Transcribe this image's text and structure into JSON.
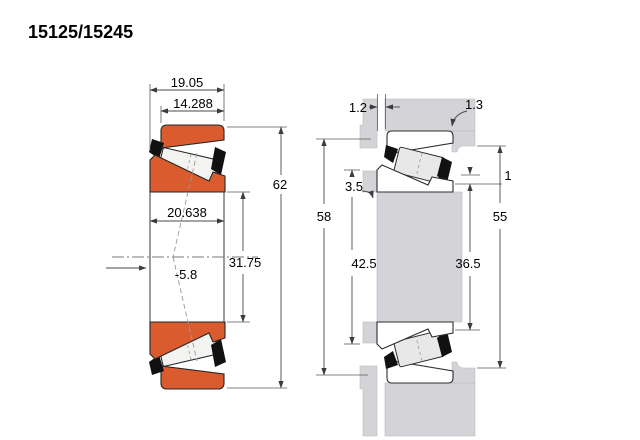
{
  "title": "15125/15245",
  "colors": {
    "ring_orange": "#d95b2e",
    "steel_gray": "#d4d4d8",
    "outline": "#262626",
    "dimension_line": "#5a5a5a",
    "background": "#ffffff"
  },
  "left_view": {
    "description": "bearing cross-section",
    "overall_width": "19.05",
    "cup_width": "14.288",
    "outer_diameter": "62",
    "cone_width": "20.638",
    "bore_diameter": "31.75",
    "load_center": "-5.8"
  },
  "right_view": {
    "description": "mounting arrangement with shaft and housing",
    "front_gap": "1.2",
    "housing_fillet": "1.3",
    "shoulder_clearance": "3.5",
    "housing_bore_abutment": "58",
    "shaft_shoulder_diameter": "42.5",
    "backing_clearance": "1",
    "housing_shoulder_diameter": "55",
    "shaft_backing_diameter": "36.5"
  }
}
